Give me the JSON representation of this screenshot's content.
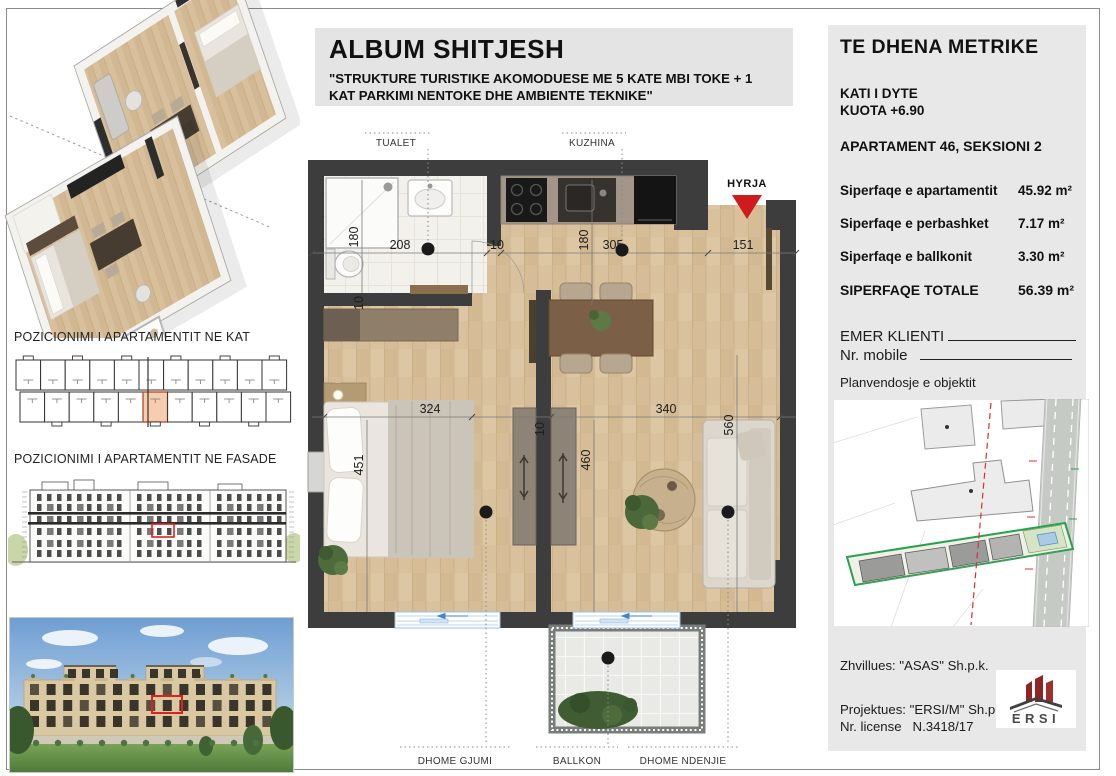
{
  "title_block": {
    "title": "ALBUM SHITJESH",
    "subtitle": "\"STRUKTURE TURISTIKE AKOMODUESE ME 5 KATE MBI TOKE + 1 KAT PARKIMI NENTOKE DHE AMBIENTE TEKNIKE\""
  },
  "left_panel": {
    "floor_position_label": "POZICIONIMI I APARTAMENTIT NE KAT",
    "facade_position_label": "POZICIONIMI I APARTAMENTIT NE FASADE"
  },
  "floor_plan": {
    "labels": {
      "bathroom": "TUALET",
      "kitchen": "KUZHINA",
      "entrance": "HYRJA",
      "bedroom": "DHOME GJUMI",
      "balcony": "BALLKON",
      "living": "DHOME NDENJIE"
    },
    "dimensions": {
      "bath_width": "208",
      "bath_height": "180",
      "wall_gap_top": "10",
      "kitchen_width": "305",
      "kitchen_height": "180",
      "entry_width": "151",
      "bedroom_width": "324",
      "bedroom_height": "451",
      "bath_wall": "10",
      "living_width": "340",
      "center_height": "460",
      "living_height": "560",
      "center_wall": "10"
    }
  },
  "metrics_panel": {
    "heading": "TE DHENA METRIKE",
    "floor_label": "KATI I DYTE",
    "elevation_label": "KUOTA +6.90",
    "apartment_label": "APARTAMENT 46, SEKSIONI 2",
    "areas": [
      {
        "label": "Siperfaqe e apartamentit",
        "value": "45.92 m²"
      },
      {
        "label": "Siperfaqe e perbashket",
        "value": "7.17 m²"
      },
      {
        "label": "Siperfaqe e ballkonit",
        "value": "3.30 m²"
      },
      {
        "label": "SIPERFAQE TOTALE",
        "value": "56.39 m²"
      }
    ],
    "client_label": "EMER KLIENTI",
    "mobile_label": "Nr. mobile",
    "siteplan_label": "Planvendosje e objektit",
    "developer": "Zhvillues: \"ASAS\" Sh.p.k.",
    "designer": "Projektues: \"ERSI/M\" Sh.p.k.",
    "license": "Nr. license   N.3418/17",
    "logo_text": "ERSI"
  },
  "colors": {
    "accent_red": "#cf1b1b",
    "highlight_peach": "#f6cdb0",
    "wall": "#3d3d3d",
    "wood_floor": "#d9c19e",
    "panel_bg": "#e8e8e8",
    "logo_red": "#8e2424",
    "siteplan_green": "#27a24c"
  }
}
